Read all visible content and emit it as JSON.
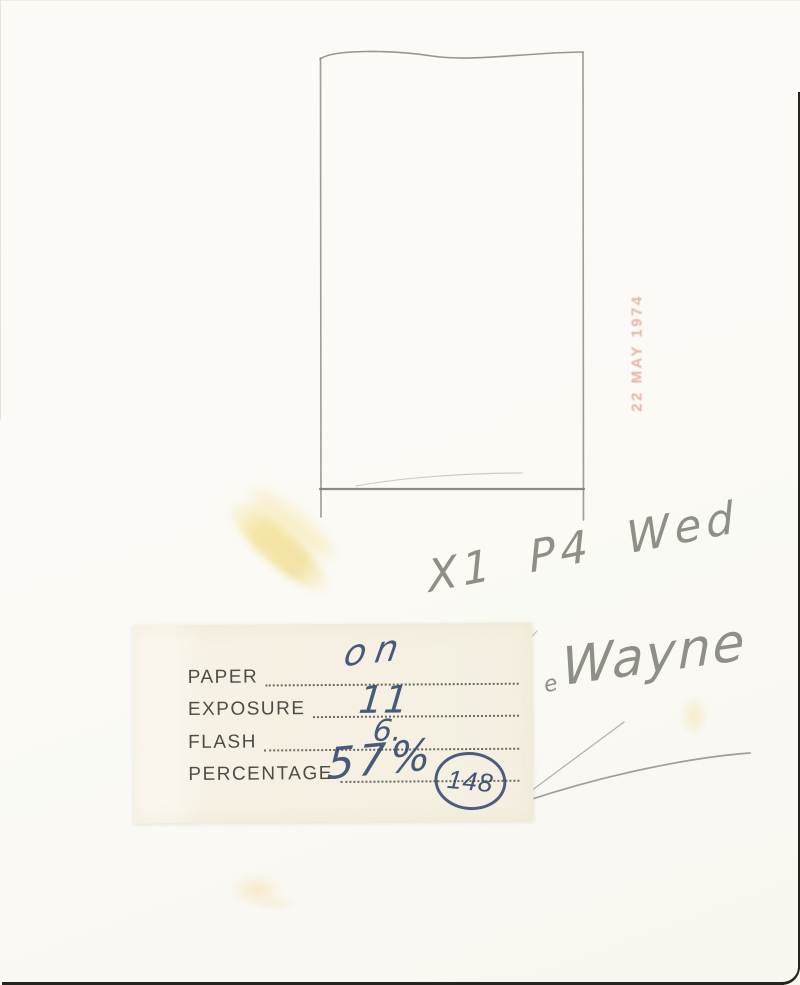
{
  "scan": {
    "stamp_text": "22 MAY 1974",
    "pencil_note": "X1 P4 Wed",
    "signature_mark": "e",
    "signature": "Wayne",
    "label": {
      "rows": [
        {
          "field": "PAPER",
          "value": "on"
        },
        {
          "field": "EXPOSURE",
          "value": "11"
        },
        {
          "field": "FLASH",
          "value": "6."
        },
        {
          "field": "PERCENTAGE",
          "value": "57%"
        }
      ],
      "circled_number": "148"
    },
    "colors": {
      "paper": "#fbfaf5",
      "label_background": "#f6f1e4",
      "pencil_gray": "#8c8c82",
      "ink_blue": "#32466a",
      "stamp_red": "#d67868",
      "smudge_yellow": "#f3e296",
      "edge_dark": "#23261f"
    }
  }
}
